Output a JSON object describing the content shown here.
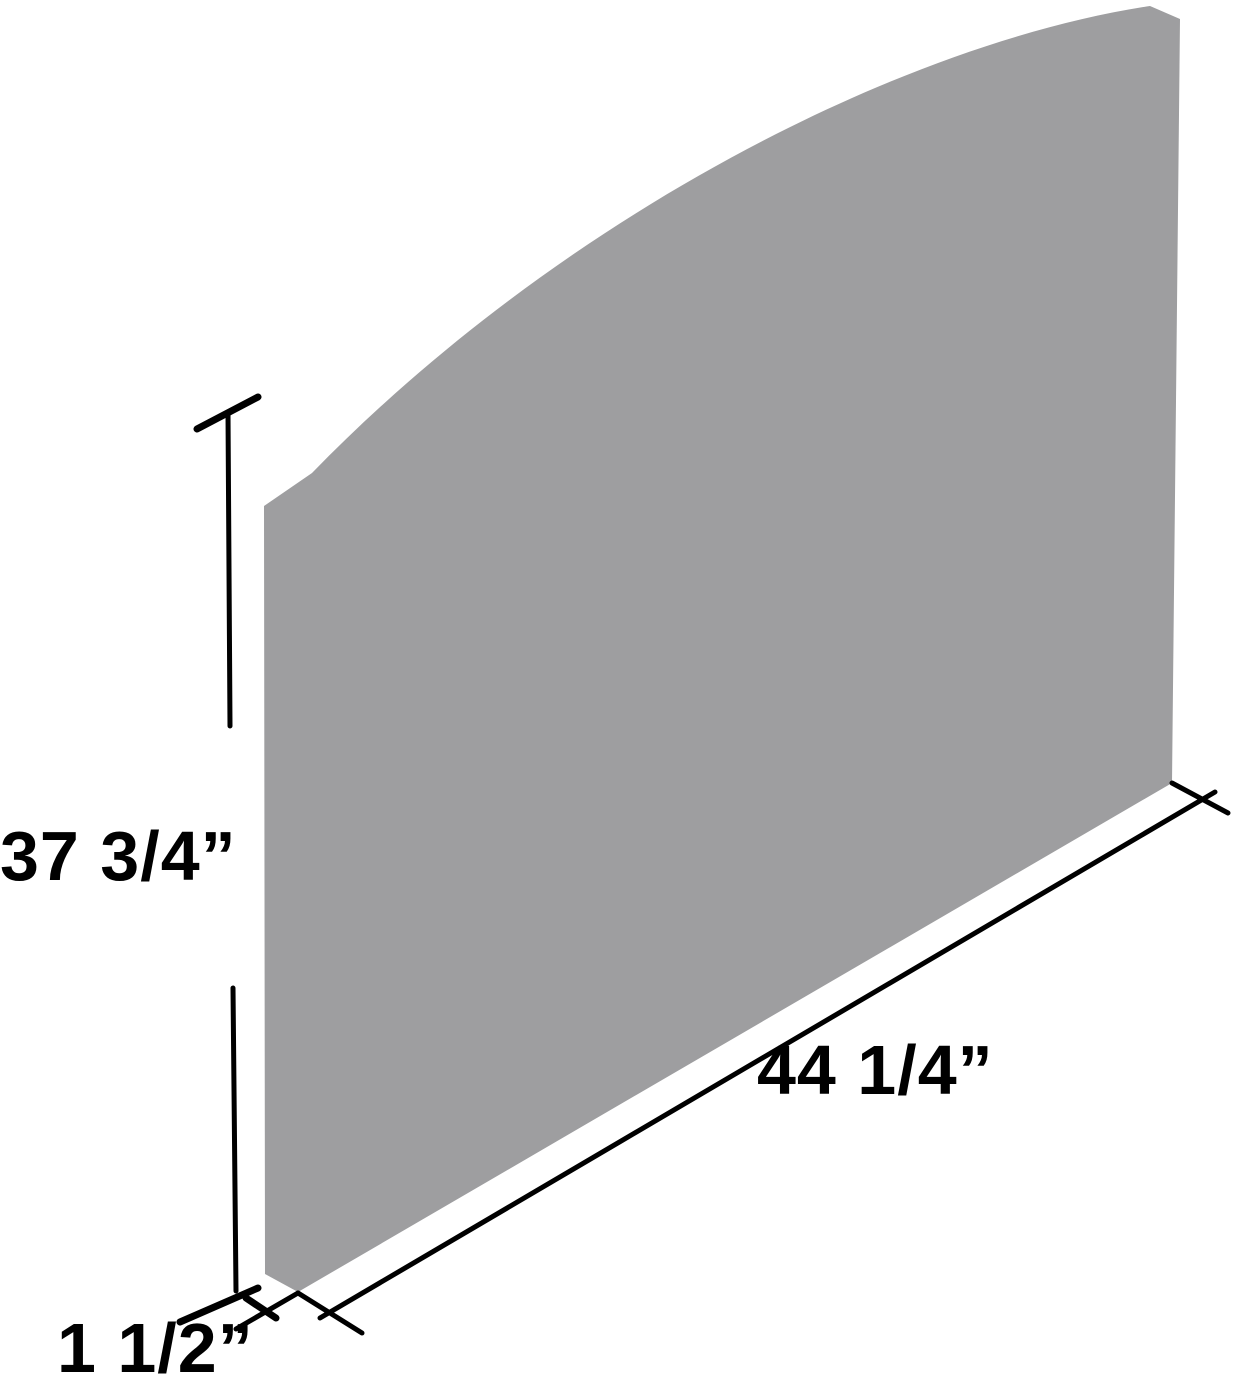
{
  "figure": {
    "type": "product-dimension-diagram",
    "background_color": "#ffffff",
    "line_color": "#000000",
    "panel": {
      "description": "curved-top-panel",
      "fill_color": "#9e9ea0",
      "path": "M264,506 L312,473 C560,218 900,44 1150,6 L1180,19 L1172,783 L298,1292 L265,1274 Z"
    },
    "dimensions": {
      "height": {
        "label": "37 3/4”",
        "value_inches": "37 3/4",
        "line_upper": "228,413 230,726",
        "line_lower": "233,988 236,1291",
        "tick_top": "197,429 258,397",
        "tick_bottom": "180,1322 258,1288"
      },
      "width": {
        "label": "44 1/4”",
        "value_inches": "44 1/4",
        "dim_line": "320,1318 1215,792",
        "ext_left": "298,1293 362,1333",
        "ext_right": "1172,783 1228,813"
      },
      "depth": {
        "label": "1 1/2”",
        "value_inches": "1 1/2",
        "ext_line": "298,1293 236,1329",
        "dim_line": "246,1298 276,1318"
      }
    }
  }
}
